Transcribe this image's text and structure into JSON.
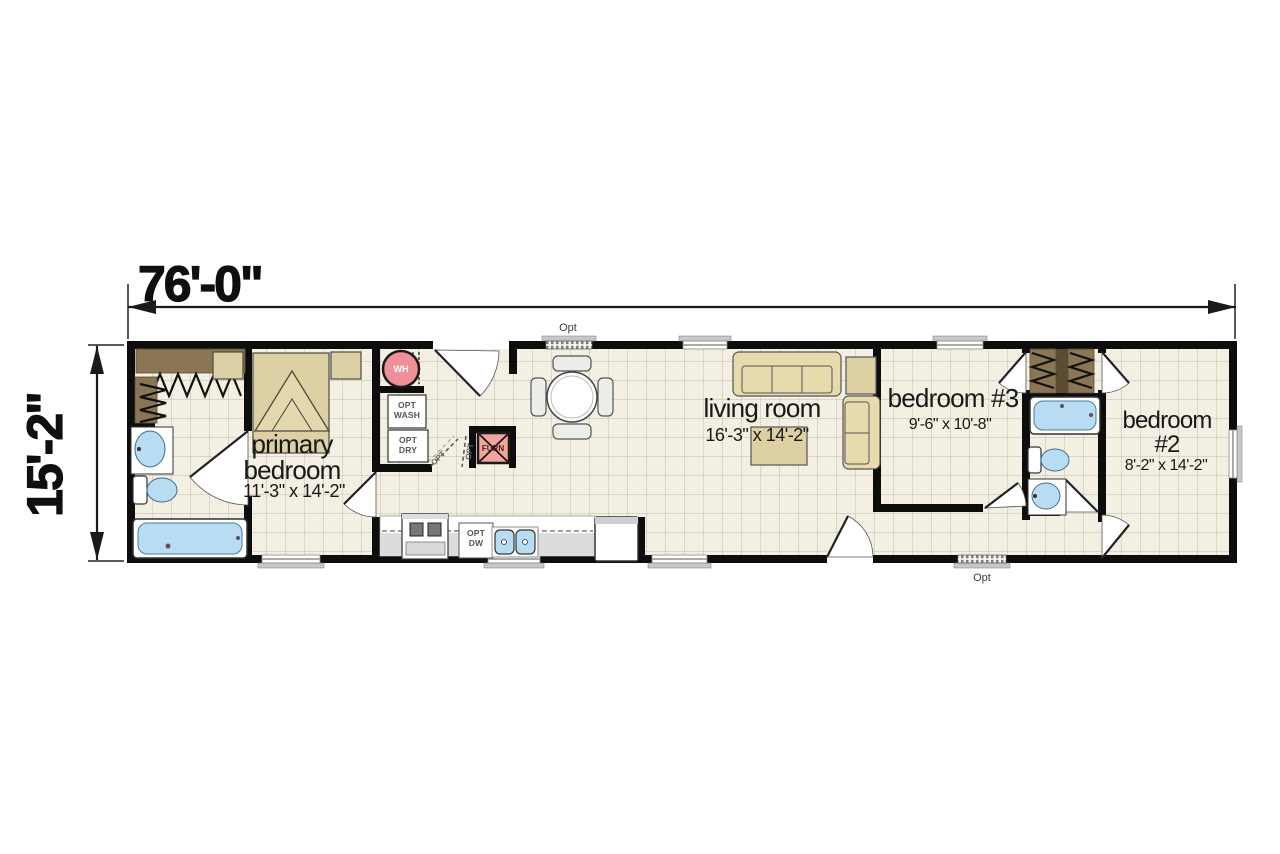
{
  "dimensions": {
    "width_label": "76'-0\"",
    "height_label": "15'-2\""
  },
  "rooms": {
    "primary_bedroom": {
      "line1": "primary",
      "line2": "bedroom",
      "size": "11'-3\" x 14'-2\""
    },
    "living_room": {
      "line1": "living room",
      "size": "16'-3\" x 14'-2\""
    },
    "bedroom_3": {
      "line1": "bedroom #3",
      "size": "9'-6\" x 10'-8\""
    },
    "bedroom_2": {
      "line1": "bedroom",
      "line2": "#2",
      "size": "8'-2\" x 14'-2\""
    }
  },
  "fixtures": {
    "wh": "WH",
    "wash_l1": "OPT",
    "wash_l2": "WASH",
    "dry_l1": "OPT",
    "dry_l2": "DRY",
    "furn": "FURN",
    "dw_l1": "OPT",
    "dw_l2": "DW",
    "opt_door_a": "OPT",
    "opt_door_b": "OPT"
  },
  "options": {
    "top_window": "Opt",
    "bottom_window": "Opt"
  },
  "colors": {
    "wall": "#0d0d0d",
    "floor": "#f3efe2",
    "grid_line": "#bfbbac",
    "furniture_tan": "#ddd0a4",
    "fixture_blue": "#b8dcf2",
    "water_heater_pink": "#ef8f98",
    "furnace_pink": "#f2a49e",
    "counter_gray": "#dcdcdc",
    "closet_brown": "#8a7554"
  }
}
